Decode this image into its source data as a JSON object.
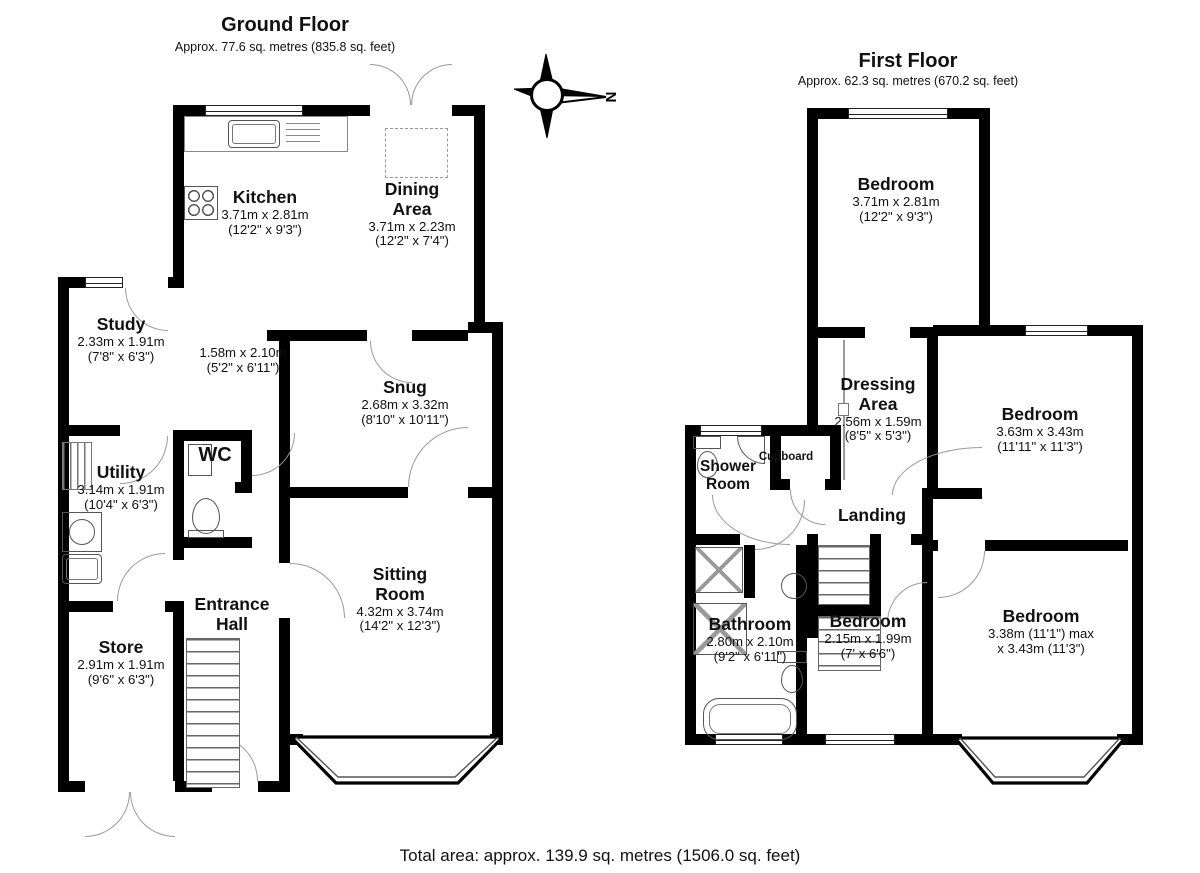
{
  "ground_floor": {
    "title": "Ground Floor",
    "subtitle": "Approx. 77.6 sq. metres (835.8 sq. feet)",
    "rooms": {
      "kitchen": {
        "name": "Kitchen",
        "metric": "3.71m x 2.81m",
        "imperial": "(12'2\" x 9'3\")"
      },
      "dining": {
        "name": "Dining Area",
        "metric": "3.71m x 2.23m",
        "imperial": "(12'2\" x 7'4\")"
      },
      "study": {
        "name": "Study",
        "metric": "2.33m x 1.91m",
        "imperial": "(7'8\" x 6'3\")"
      },
      "hall_space": {
        "metric": "1.58m x 2.10m",
        "imperial": "(5'2\" x 6'11\")"
      },
      "snug": {
        "name": "Snug",
        "metric": "2.68m x 3.32m",
        "imperial": "(8'10\" x 10'11\")"
      },
      "wc": {
        "name": "WC"
      },
      "utility": {
        "name": "Utility",
        "metric": "3.14m x 1.91m",
        "imperial": "(10'4\" x 6'3\")"
      },
      "entrance_hall": {
        "name": "Entrance Hall"
      },
      "sitting_room": {
        "name": "Sitting Room",
        "metric": "4.32m x 3.74m",
        "imperial": "(14'2\" x 12'3\")"
      },
      "store": {
        "name": "Store",
        "metric": "2.91m x 1.91m",
        "imperial": "(9'6\" x 6'3\")"
      }
    }
  },
  "first_floor": {
    "title": "First Floor",
    "subtitle": "Approx. 62.3 sq. metres (670.2 sq. feet)",
    "rooms": {
      "bedroom1": {
        "name": "Bedroom",
        "metric": "3.71m x 2.81m",
        "imperial": "(12'2\" x 9'3\")"
      },
      "dressing": {
        "name": "Dressing Area",
        "metric": "2.56m x 1.59m",
        "imperial": "(8'5\" x 5'3\")"
      },
      "bedroom2": {
        "name": "Bedroom",
        "metric": "3.63m x 3.43m",
        "imperial": "(11'11\" x 11'3\")"
      },
      "shower": {
        "name": "Shower Room"
      },
      "cupboard": {
        "name": "Cupboard"
      },
      "landing": {
        "name": "Landing"
      },
      "bathroom": {
        "name": "Bathroom",
        "metric": "2.80m x 2.10m",
        "imperial": "(9'2\" x 6'11\")"
      },
      "bedroom3": {
        "name": "Bedroom",
        "metric": "2.15m x 1.99m",
        "imperial": "(7' x 6'6\")"
      },
      "bedroom4": {
        "name": "Bedroom",
        "metric": "3.38m (11'1\") max",
        "imperial": "x 3.43m (11'3\")"
      }
    }
  },
  "compass": {
    "north_label": "N"
  },
  "footer": {
    "total_area": "Total area: approx. 139.9 sq. metres (1506.0 sq. feet)"
  }
}
